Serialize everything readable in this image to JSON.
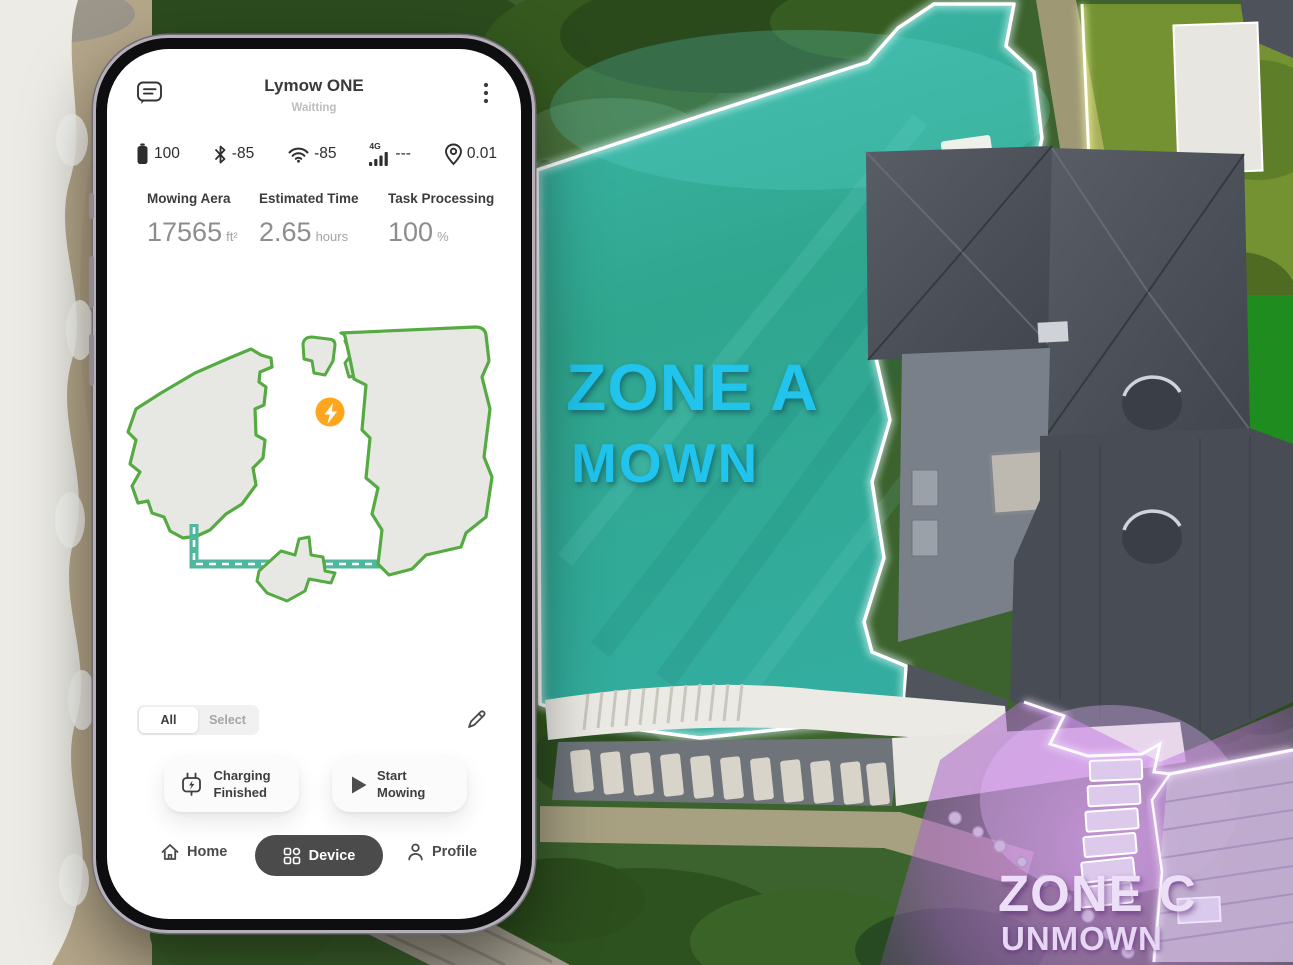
{
  "zones": {
    "a": {
      "name": "ZONE A",
      "status": "MOWN"
    },
    "c": {
      "name": "ZONE C",
      "status": "UNMOWN"
    }
  },
  "app": {
    "title": "Lymow ONE",
    "subtitle": "Waitting",
    "status": {
      "battery": "100",
      "bluetooth": "-85",
      "wifi": "-85",
      "cellular_label": "4G",
      "cellular": "---",
      "gps": "0.01"
    },
    "stats": [
      {
        "label": "Mowing Aera",
        "value": "17565",
        "unit": "ft²"
      },
      {
        "label": "Estimated Time",
        "value": "2.65",
        "unit": "hours"
      },
      {
        "label": "Task Processing",
        "value": "100",
        "unit": "%"
      }
    ],
    "map": {
      "marker": "charging-station"
    },
    "filter_tabs": {
      "all": "All",
      "select": "Select"
    },
    "actions": {
      "charging": "Charging Finished",
      "start": "Start Mowing"
    },
    "nav": [
      {
        "label": "Home",
        "active": false
      },
      {
        "label": "Device",
        "active": true
      },
      {
        "label": "Profile",
        "active": false
      }
    ]
  },
  "colors": {
    "accent_cyan": "#20C4EC",
    "zone_c_text": "#EEDFF8",
    "map_outline_green": "#55AA41",
    "dock_path_teal": "#4FB79D",
    "marker_orange": "#FFA51E",
    "nav_active_bg": "#4B4B4B"
  }
}
